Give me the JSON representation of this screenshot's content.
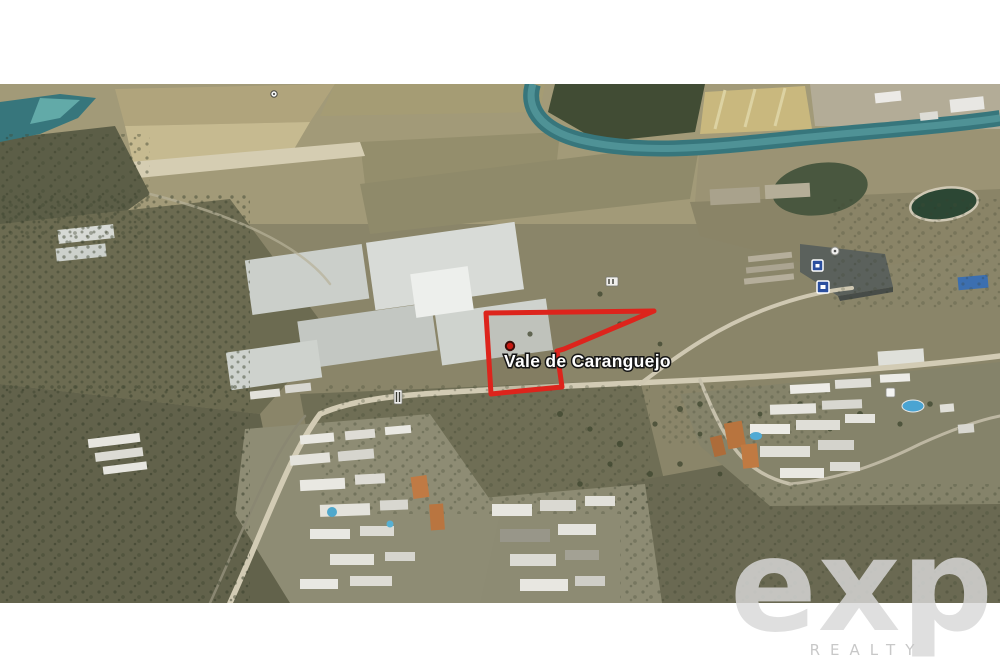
{
  "window": {
    "width_px": 1000,
    "height_px": 667
  },
  "map": {
    "place_label": "Vale de Caranguejo",
    "parcel_points": "486,229 654,227 564,265 557,267 562,303 520,307 491,310",
    "icons": {
      "placemark": "red-dot-placemark-icon",
      "poi_blue": "blue-square-poi-icon",
      "road_sign": "road-sign-icon",
      "poi_dot": "white-dot-poi-icon"
    }
  },
  "watermark": {
    "brand": "exp",
    "subtitle": "REALTY"
  },
  "colors": {
    "page-bg": "#ffffff",
    "parcel-red": "#dd241c",
    "marker-red": "#c81912",
    "label-text": "#ffffff",
    "label-outline": "#141414",
    "water-teal": "#37767c",
    "watermark-gray": "#d9d9d9",
    "poi-blue": "#2b4f9e"
  }
}
